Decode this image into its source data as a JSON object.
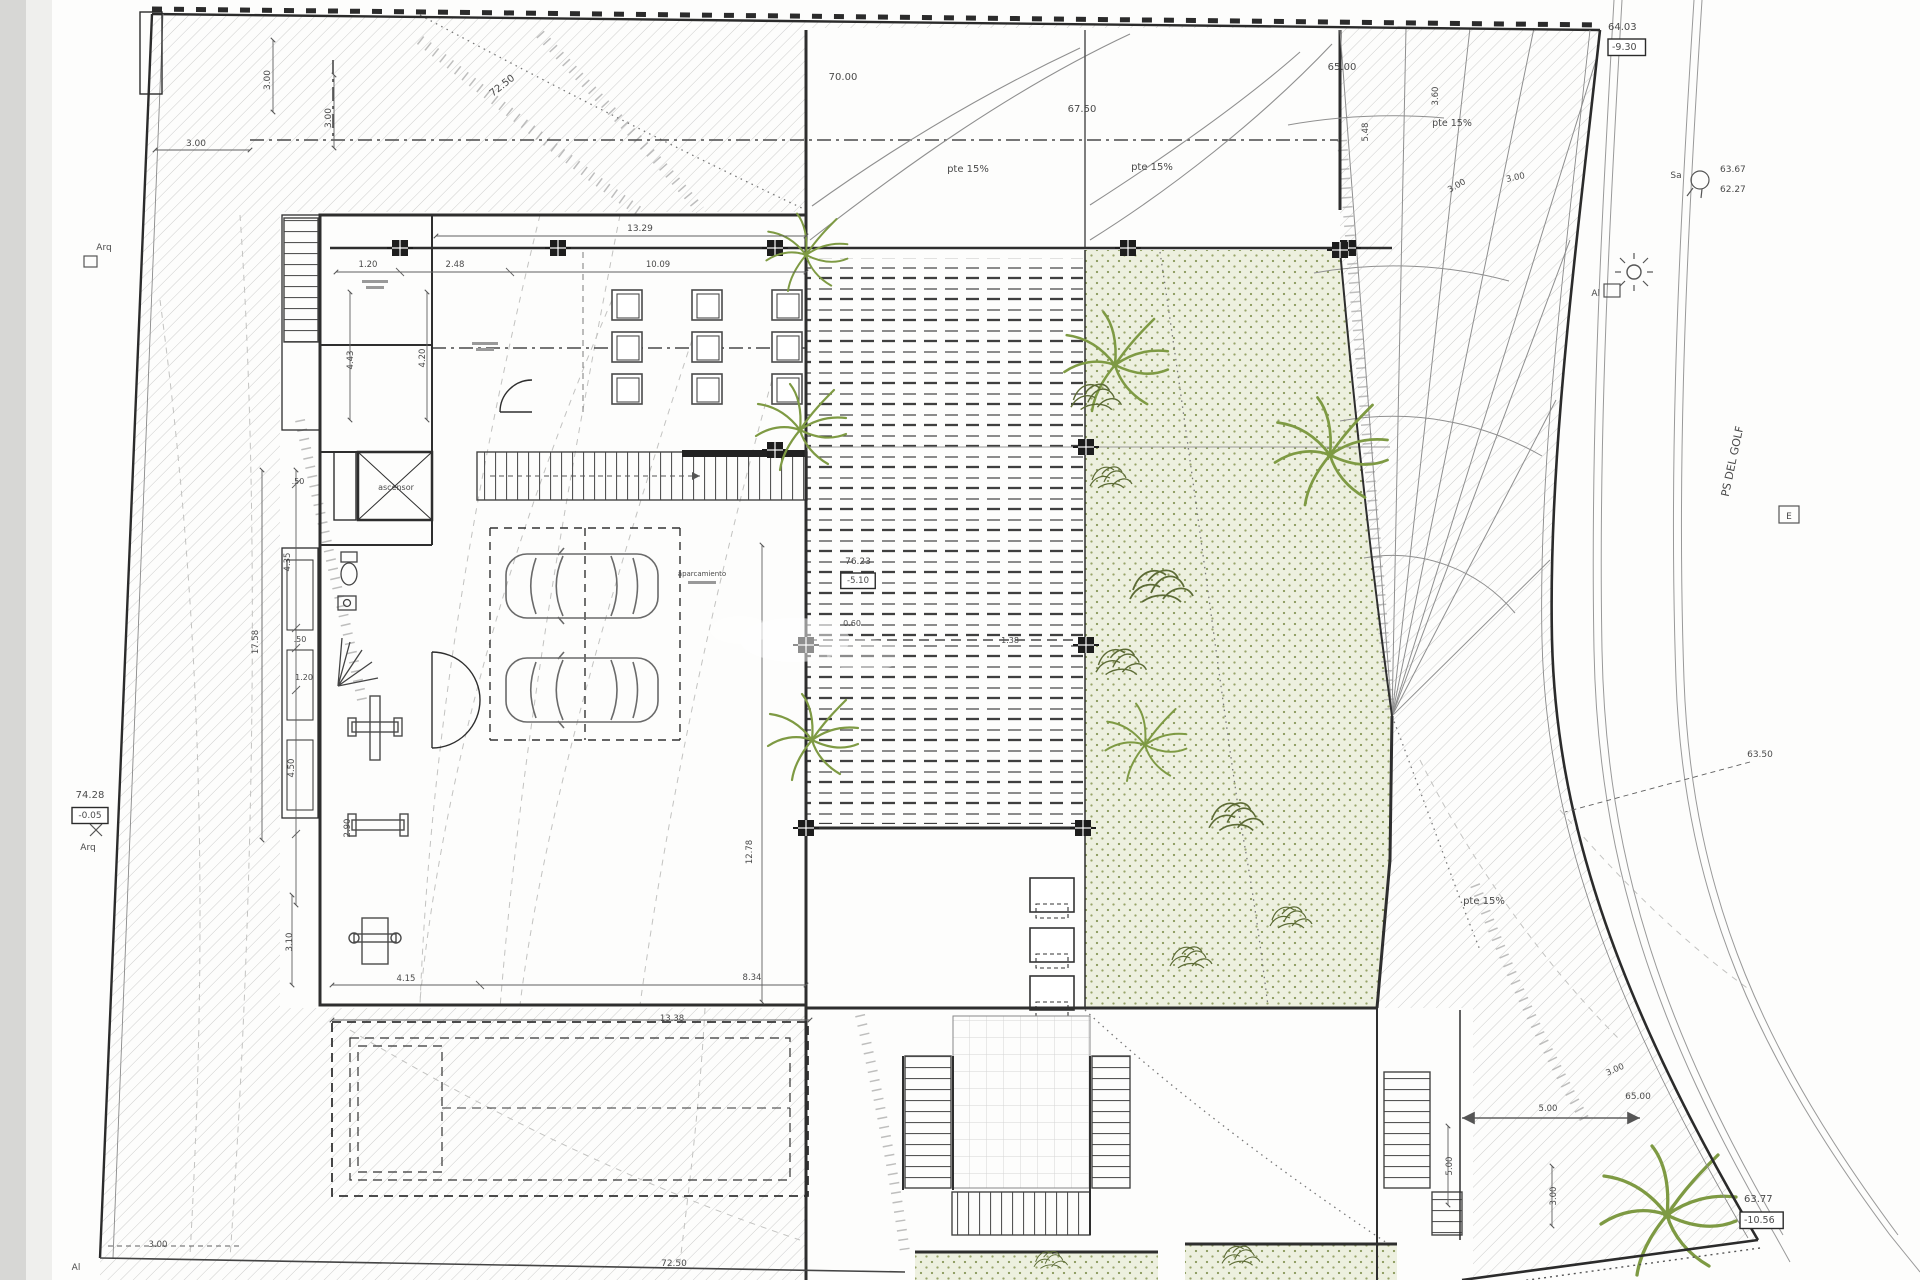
{
  "canvas": {
    "width": 1920,
    "height": 1280
  },
  "drawing": {
    "kind": "architectural-site-plan",
    "street_label": "PS DEL GOLF",
    "slope_note": "pte 15%",
    "room_labels": [
      "ascensor",
      "aparcamiento"
    ],
    "level_markers": [
      {
        "elevation": "64.03",
        "relative": "-9.30"
      },
      {
        "elevation": "74.28",
        "relative": "-0.05"
      },
      {
        "elevation": "76.23",
        "relative": "-5.10"
      },
      {
        "elevation": "63.77",
        "relative": "-10.56"
      },
      {
        "elevation": "63.67"
      },
      {
        "elevation": "62.27"
      },
      {
        "elevation": "63.50"
      },
      {
        "elevation": "72.50"
      },
      {
        "elevation": "70.00"
      },
      {
        "elevation": "67.50"
      },
      {
        "elevation": "65.00"
      }
    ],
    "surveyor_marks": [
      "Arq",
      "Al",
      "Sa",
      "E"
    ]
  },
  "colors": {
    "paper": "#fdfdfc",
    "page_strip1": "#d7d7d5",
    "page_strip2": "#efefed",
    "line": "#3a3a3a",
    "hatch": "#c9c9c7",
    "green_fill": "#edf0df",
    "green_dot": "#97a468",
    "palm": "#7e9a43",
    "bush": "#5c6b35",
    "dim": "#5f5f5f",
    "label": "#4a4a4a"
  },
  "labels": [
    {
      "t": "3.00",
      "x": 196,
      "y": 146,
      "s": 9
    },
    {
      "t": "3.00",
      "x": 270,
      "y": 80,
      "r": -90,
      "s": 9
    },
    {
      "t": "3.00",
      "x": 331,
      "y": 118,
      "r": -90,
      "s": 9
    },
    {
      "t": "72.50",
      "x": 504,
      "y": 88,
      "r": -38,
      "s": 10
    },
    {
      "t": "70.00",
      "x": 843,
      "y": 80,
      "s": 10
    },
    {
      "t": "pte 15%",
      "x": 968,
      "y": 172,
      "s": 10
    },
    {
      "t": "67.50",
      "x": 1082,
      "y": 112,
      "s": 10
    },
    {
      "t": "pte 15%",
      "x": 1152,
      "y": 170,
      "s": 10
    },
    {
      "t": "65.00",
      "x": 1342,
      "y": 70,
      "s": 10
    },
    {
      "t": "5.48",
      "x": 1368,
      "y": 132,
      "r": -90,
      "s": 8.5
    },
    {
      "t": "pte 15%",
      "x": 1452,
      "y": 126,
      "s": 9.5
    },
    {
      "t": "3.60",
      "x": 1438,
      "y": 96,
      "r": -90,
      "s": 8.5
    },
    {
      "t": "3.00",
      "x": 1458,
      "y": 188,
      "r": -30,
      "s": 8.5
    },
    {
      "t": "3.00",
      "x": 1516,
      "y": 180,
      "r": -12,
      "s": 8.5
    },
    {
      "t": "64.03",
      "x": 1608,
      "y": 30,
      "a": "start",
      "s": 10
    },
    {
      "t": "-9.30",
      "x": 1612,
      "y": 50,
      "a": "start",
      "s": 9.5,
      "boxed": true
    },
    {
      "t": "Sa",
      "x": 1676,
      "y": 178,
      "s": 9
    },
    {
      "t": "63.67",
      "x": 1720,
      "y": 172,
      "a": "start",
      "s": 9
    },
    {
      "t": "62.27",
      "x": 1720,
      "y": 192,
      "a": "start",
      "s": 9
    },
    {
      "t": "Al",
      "x": 1600,
      "y": 296,
      "a": "end",
      "s": 9
    },
    {
      "t": "PS DEL GOLF",
      "x": 1736,
      "y": 462,
      "r": -78,
      "s": 11,
      "c": "#555555"
    },
    {
      "t": "E",
      "x": 1789,
      "y": 519,
      "s": 9
    },
    {
      "t": "63.50",
      "x": 1760,
      "y": 757,
      "s": 9
    },
    {
      "t": "pte 15%",
      "x": 1484,
      "y": 904,
      "s": 10
    },
    {
      "t": "3.00",
      "x": 1616,
      "y": 1072,
      "r": -24,
      "s": 8.5
    },
    {
      "t": "65.00",
      "x": 1638,
      "y": 1099,
      "s": 9
    },
    {
      "t": "5.00",
      "x": 1548,
      "y": 1111,
      "s": 8.5
    },
    {
      "t": "5.00",
      "x": 1452,
      "y": 1166,
      "r": -90,
      "s": 8.5
    },
    {
      "t": "3.00",
      "x": 1556,
      "y": 1196,
      "r": -90,
      "s": 8.5
    },
    {
      "t": "63.77",
      "x": 1744,
      "y": 1202,
      "a": "start",
      "s": 10
    },
    {
      "t": "-10.56",
      "x": 1744,
      "y": 1223,
      "a": "start",
      "s": 9.5,
      "boxed": true
    },
    {
      "t": "13.29",
      "x": 640,
      "y": 231,
      "s": 9
    },
    {
      "t": "1.20",
      "x": 368,
      "y": 267,
      "s": 8.5
    },
    {
      "t": "2.48",
      "x": 455,
      "y": 267,
      "s": 8.5
    },
    {
      "t": "10.09",
      "x": 658,
      "y": 267,
      "s": 8.5
    },
    {
      "t": "Arq",
      "x": 104,
      "y": 250,
      "s": 9
    },
    {
      "t": "74.28",
      "x": 90,
      "y": 798,
      "s": 10
    },
    {
      "t": "-0.05",
      "x": 90,
      "y": 818,
      "s": 9,
      "boxed": true
    },
    {
      "t": "Arq",
      "x": 88,
      "y": 850,
      "s": 9
    },
    {
      "t": "17.58",
      "x": 258,
      "y": 642,
      "r": -90,
      "s": 8.5
    },
    {
      "t": ".50",
      "x": 298,
      "y": 484,
      "s": 8
    },
    {
      "t": "4.35",
      "x": 290,
      "y": 562,
      "r": -90,
      "s": 8.5
    },
    {
      "t": ".50",
      "x": 300,
      "y": 642,
      "s": 8
    },
    {
      "t": "1.20",
      "x": 304,
      "y": 680,
      "s": 8
    },
    {
      "t": "4.50",
      "x": 294,
      "y": 768,
      "r": -90,
      "s": 8.5
    },
    {
      "t": "2.90",
      "x": 350,
      "y": 828,
      "r": -90,
      "s": 8.5
    },
    {
      "t": "3.10",
      "x": 292,
      "y": 942,
      "r": -90,
      "s": 8.5
    },
    {
      "t": "4.43",
      "x": 353,
      "y": 360,
      "r": -90,
      "s": 8.5
    },
    {
      "t": "4.20",
      "x": 425,
      "y": 358,
      "r": -90,
      "s": 8.5
    },
    {
      "t": "ascensor",
      "x": 396,
      "y": 490,
      "s": 8,
      "c": "#666666"
    },
    {
      "t": "aparcamiento",
      "x": 702,
      "y": 576,
      "s": 7,
      "c": "#777777"
    },
    {
      "t": "76.23",
      "x": 858,
      "y": 564,
      "s": 9
    },
    {
      "t": "-5.10",
      "x": 858,
      "y": 583,
      "s": 8.5,
      "boxed": true
    },
    {
      "t": "0.60",
      "x": 852,
      "y": 626,
      "s": 8
    },
    {
      "t": "1.38",
      "x": 1010,
      "y": 643,
      "s": 8
    },
    {
      "t": "12.78",
      "x": 752,
      "y": 852,
      "r": -90,
      "s": 8.5
    },
    {
      "t": "4.15",
      "x": 406,
      "y": 981,
      "s": 8.5
    },
    {
      "t": "8.34",
      "x": 752,
      "y": 980,
      "s": 8.5
    },
    {
      "t": "13.38",
      "x": 672,
      "y": 1021,
      "s": 8.5
    },
    {
      "t": "72.50",
      "x": 674,
      "y": 1266,
      "s": 9
    },
    {
      "t": "3.00",
      "x": 158,
      "y": 1247,
      "s": 8.5
    },
    {
      "t": "Al",
      "x": 76,
      "y": 1270,
      "s": 9
    }
  ]
}
